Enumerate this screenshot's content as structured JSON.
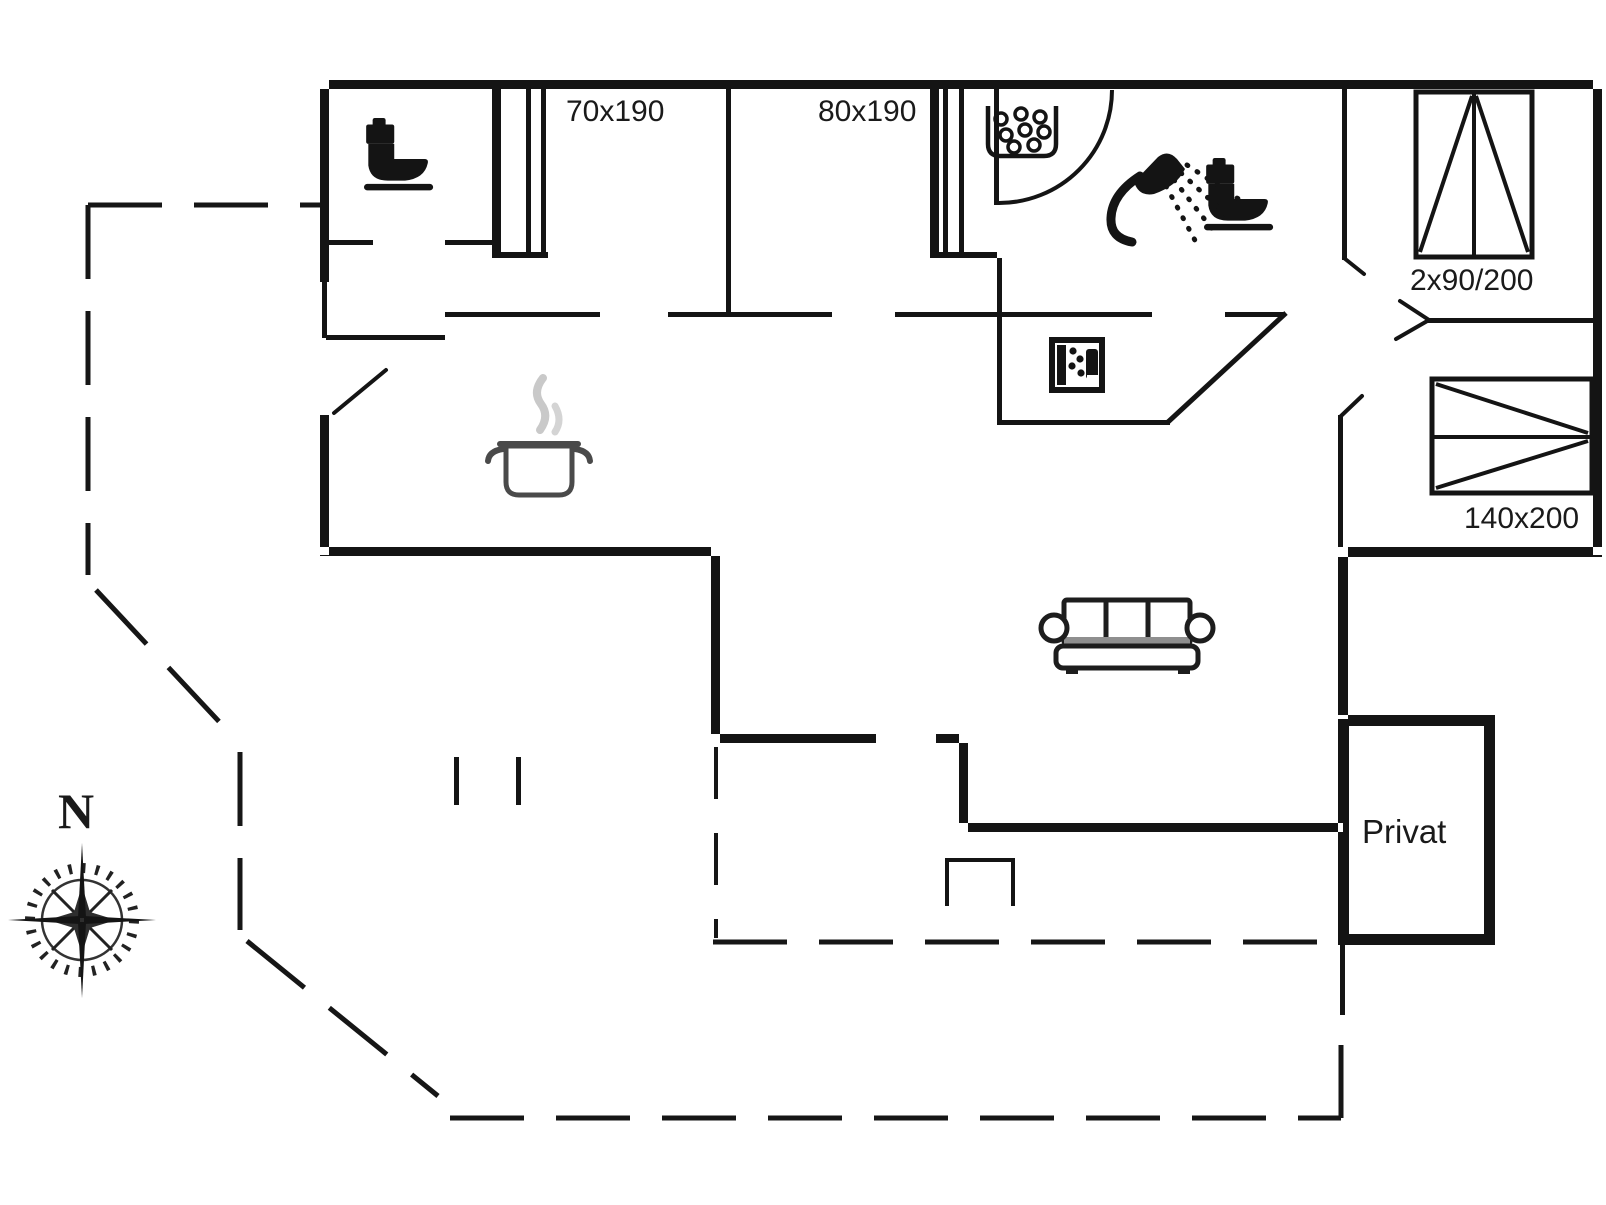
{
  "colors": {
    "background": "#ffffff",
    "line": "#141414",
    "steam_gray": "#c9c9c9",
    "pot_gray": "#4a4a4a",
    "sofa_seat_gray": "#8f8f8f"
  },
  "labels": {
    "bed_size_1": "70x190",
    "bed_size_2": "80x190",
    "wardrobe_size": "2x90/200",
    "double_bed_size": "140x200",
    "private_room": "Privat",
    "compass_north": "N"
  },
  "icons": [
    "toilet-icon",
    "toilet-icon",
    "shower-icon",
    "washbasin-icon",
    "washing-machine-icon",
    "cooking-pot-icon",
    "sofa-icon",
    "wardrobe-icon",
    "double-bed-icon",
    "compass-rose-icon"
  ]
}
